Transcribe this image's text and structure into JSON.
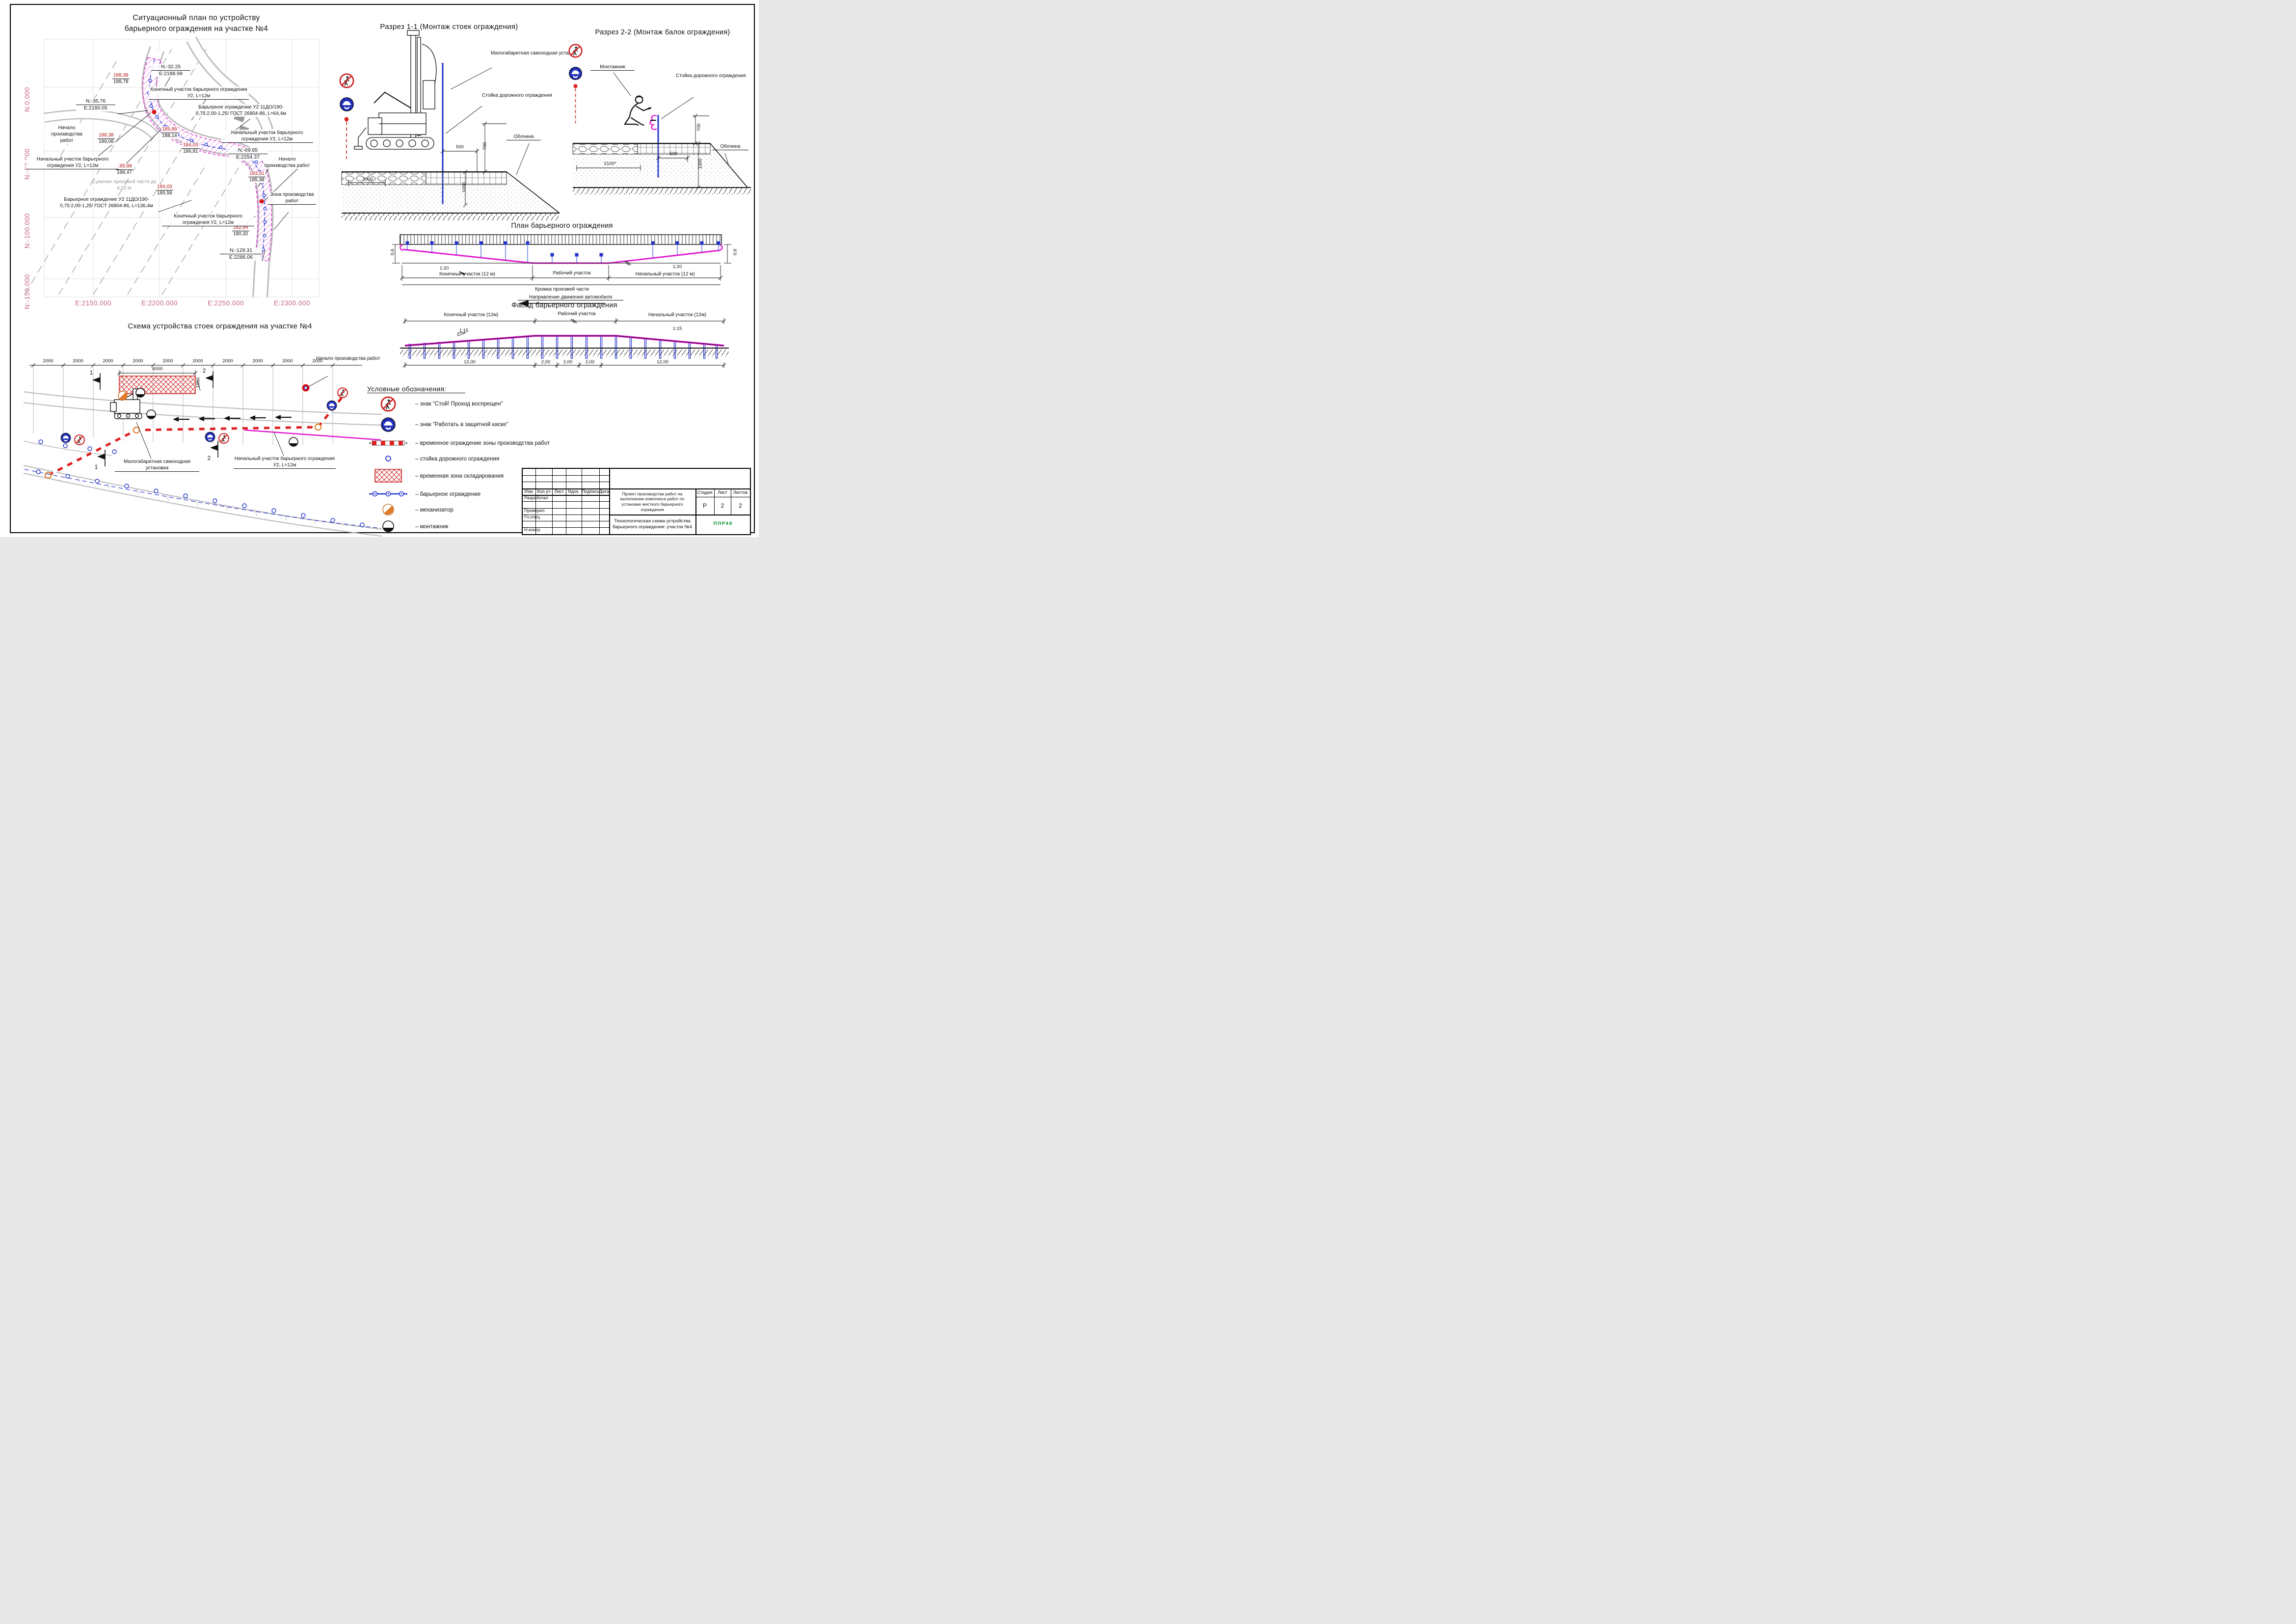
{
  "sit": {
    "title1": "Ситуационный план по устройству",
    "title2": "барьерного ограждения на участке №4",
    "n0": "N:0.000",
    "n50": "N:-50.000",
    "n100": "N:-100.000",
    "n150": "N:-150.000",
    "e2150": "E:2150.000",
    "e2200": "E:2200.000",
    "e2250": "E:2250.000",
    "e2300": "E:2300.000",
    "c1n": "N:-32.25",
    "c1e": "E:2188.99",
    "c2n": "N:-35.76",
    "c2e": "E:2180.05",
    "c3n": "N:-69.65",
    "c3e": "E:2254.37",
    "c4n": "N:-129.31",
    "c4e": "E:2286.06",
    "e1r": "188,38",
    "e1b": "188,78",
    "e2r": "188,38",
    "e2b": "189,08",
    "e3r": "185,88",
    "e3b": "188,14",
    "e4r": "185,88",
    "e4b": "188,47",
    "e5r": "184,03",
    "e5b": "186,81",
    "e6r": "184,03",
    "e6b": "185,58",
    "e7r": "183,51",
    "e7b": "185,38",
    "e8r": "182,94",
    "e8b": "180,32",
    "end_top": "Конечный участок барьерного ограждения У2, L=12м",
    "barrier64": "Барьерное ограждение У2 11ДО/190-0,75:2,00-1,25/ ГОСТ 26804-86, L=64,4м",
    "start_left": "Начало производства работ",
    "startsec_left": "Начальный участок барьерного ограждения У2, L=12м",
    "startsec_right": "Начальный участок барьерного ограждения У2, L=12м",
    "start_right": "Начало производства работ",
    "zone": "Зона производства работ",
    "narrow": "Сужение проезжей части до 6,00 м",
    "barrier136": "Барьерное ограждение У2 11ДО/190-0,75:2,00-1,25/ ГОСТ 26804-86, L=136,4м",
    "end_bottom": "Конечный участок барьерного ограждения У2, L=12м"
  },
  "s1": {
    "title": "Разрез 1-1 (Монтаж стоек ограждения)",
    "machine": "Малогабаритная самоходная установка",
    "post": "Стойка дорожного ограждения",
    "shoulder": "Обочина",
    "d500": "500",
    "d700": "700",
    "d1000": "1000"
  },
  "s2": {
    "title": "Разрез 2-2 (Монтаж балок ограждения)",
    "worker": "Монтажник",
    "post": "Стойка дорожного ограждения",
    "shoulder": "Обочина",
    "d500": "500",
    "d700": "700",
    "d2100": "2100*",
    "d1000": "1000"
  },
  "plan": {
    "title": "План барьерного ограждения",
    "d06": "0,6",
    "slope": "1:20",
    "end": "Конечный участок (12 м)",
    "work": "Рабочий участок",
    "start": "Начальный участок (12 м)",
    "edge": "Кромка проезжей части",
    "dir": "Направление движения автомобиля"
  },
  "facade": {
    "title": "Фасад барьерного ограждения",
    "end": "Конечный участок (12м)",
    "work": "Рабочий участок",
    "start": "Начальный участок (12м)",
    "slope": "1:15",
    "d12": "12,00",
    "d2": "2,00"
  },
  "scheme": {
    "title": "Схема устройства стоек ограждения на участке №4",
    "d2000": "2000",
    "d6000": "6000",
    "d1000": "1000",
    "m1": "1",
    "m2": "2",
    "start": "Начало производства работ",
    "machine": "Малогабаритная самоходная установка",
    "startsec": "Начальный участок барьерного ограждения У2, L=12м"
  },
  "legend": {
    "title": "Условные обозначения:",
    "items": [
      {
        "text": "– знак \"Стой! Проход воспрещен\""
      },
      {
        "text": "– знак \"Работать в защитной каске\""
      },
      {
        "text": "– временное ограждение зоны производства работ"
      },
      {
        "text": "– стойка дорожного ограждения"
      },
      {
        "text": "– временная зона складирования"
      },
      {
        "text": "– барьерное ограждение"
      },
      {
        "text": "– механизатор"
      },
      {
        "text": "– монтажник"
      }
    ]
  },
  "tb": {
    "c1": "Изм.",
    "c2": "Кол.уч",
    "c3": "Лист",
    "c4": "Nдок.",
    "c5": "Подпись",
    "c6": "Дата",
    "r1": "Разработал",
    "r2": "Проверил",
    "r3": "Гл.спец.",
    "r4": "Н.контр.",
    "project": "Проект производства работ на выполнение комплекса работ по установке жесткого барьерного ограждения",
    "doc": "Технологическая схема устройства барьерного ограждения: участок №4",
    "stage_h": "Стадия",
    "sheet_h": "Лист",
    "sheets_h": "Листов",
    "stage": "Р",
    "sheet": "2",
    "sheets": "2",
    "logo": "ППР48"
  },
  "colors": {
    "magenta": "#e020d0",
    "blue": "#2233cc",
    "red": "#dd2222",
    "crimson_text": "#b51111",
    "axis_pink": "#c4647e",
    "orange": "#e07a28",
    "green_logo": "#1e9e3f",
    "road_gray": "#b8b8b8"
  }
}
